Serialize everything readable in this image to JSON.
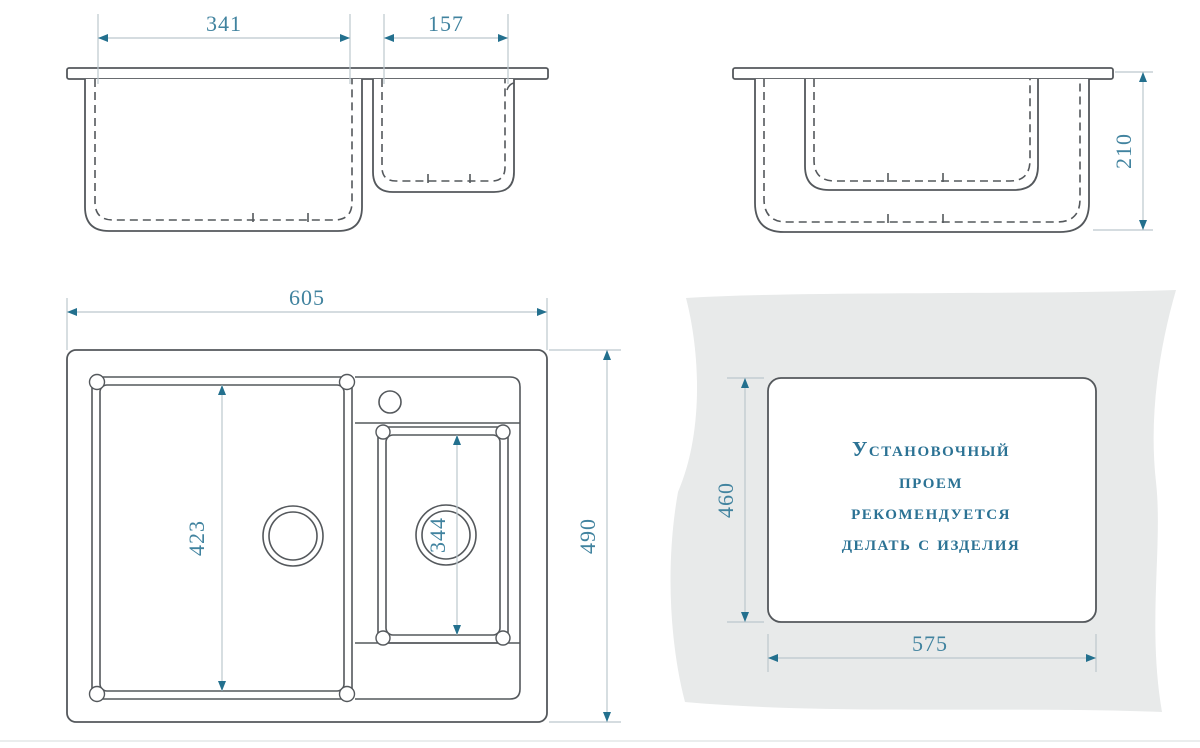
{
  "views": {
    "front": {
      "dims": {
        "big_bowl_width": "341",
        "small_bowl_width": "157"
      }
    },
    "side": {
      "dims": {
        "bowl_depth": "210"
      }
    },
    "top": {
      "dims": {
        "overall_width": "605",
        "overall_depth": "490",
        "main_bowl_length": "423",
        "second_bowl_length": "344"
      }
    },
    "cutout": {
      "dims": {
        "opening_depth": "460",
        "opening_width": "575"
      },
      "note_lines": [
        "Установочный",
        "проем",
        "рекомендуется",
        "делать с изделия"
      ]
    }
  },
  "colors": {
    "outline": "#54585c",
    "dimension_line": "#bcc7cd",
    "arrow": "#23708e",
    "dimension_text": "#41839f",
    "note_text": "#2b7294",
    "countertop_fill": "#e8eaea",
    "background": "#ffffff"
  }
}
